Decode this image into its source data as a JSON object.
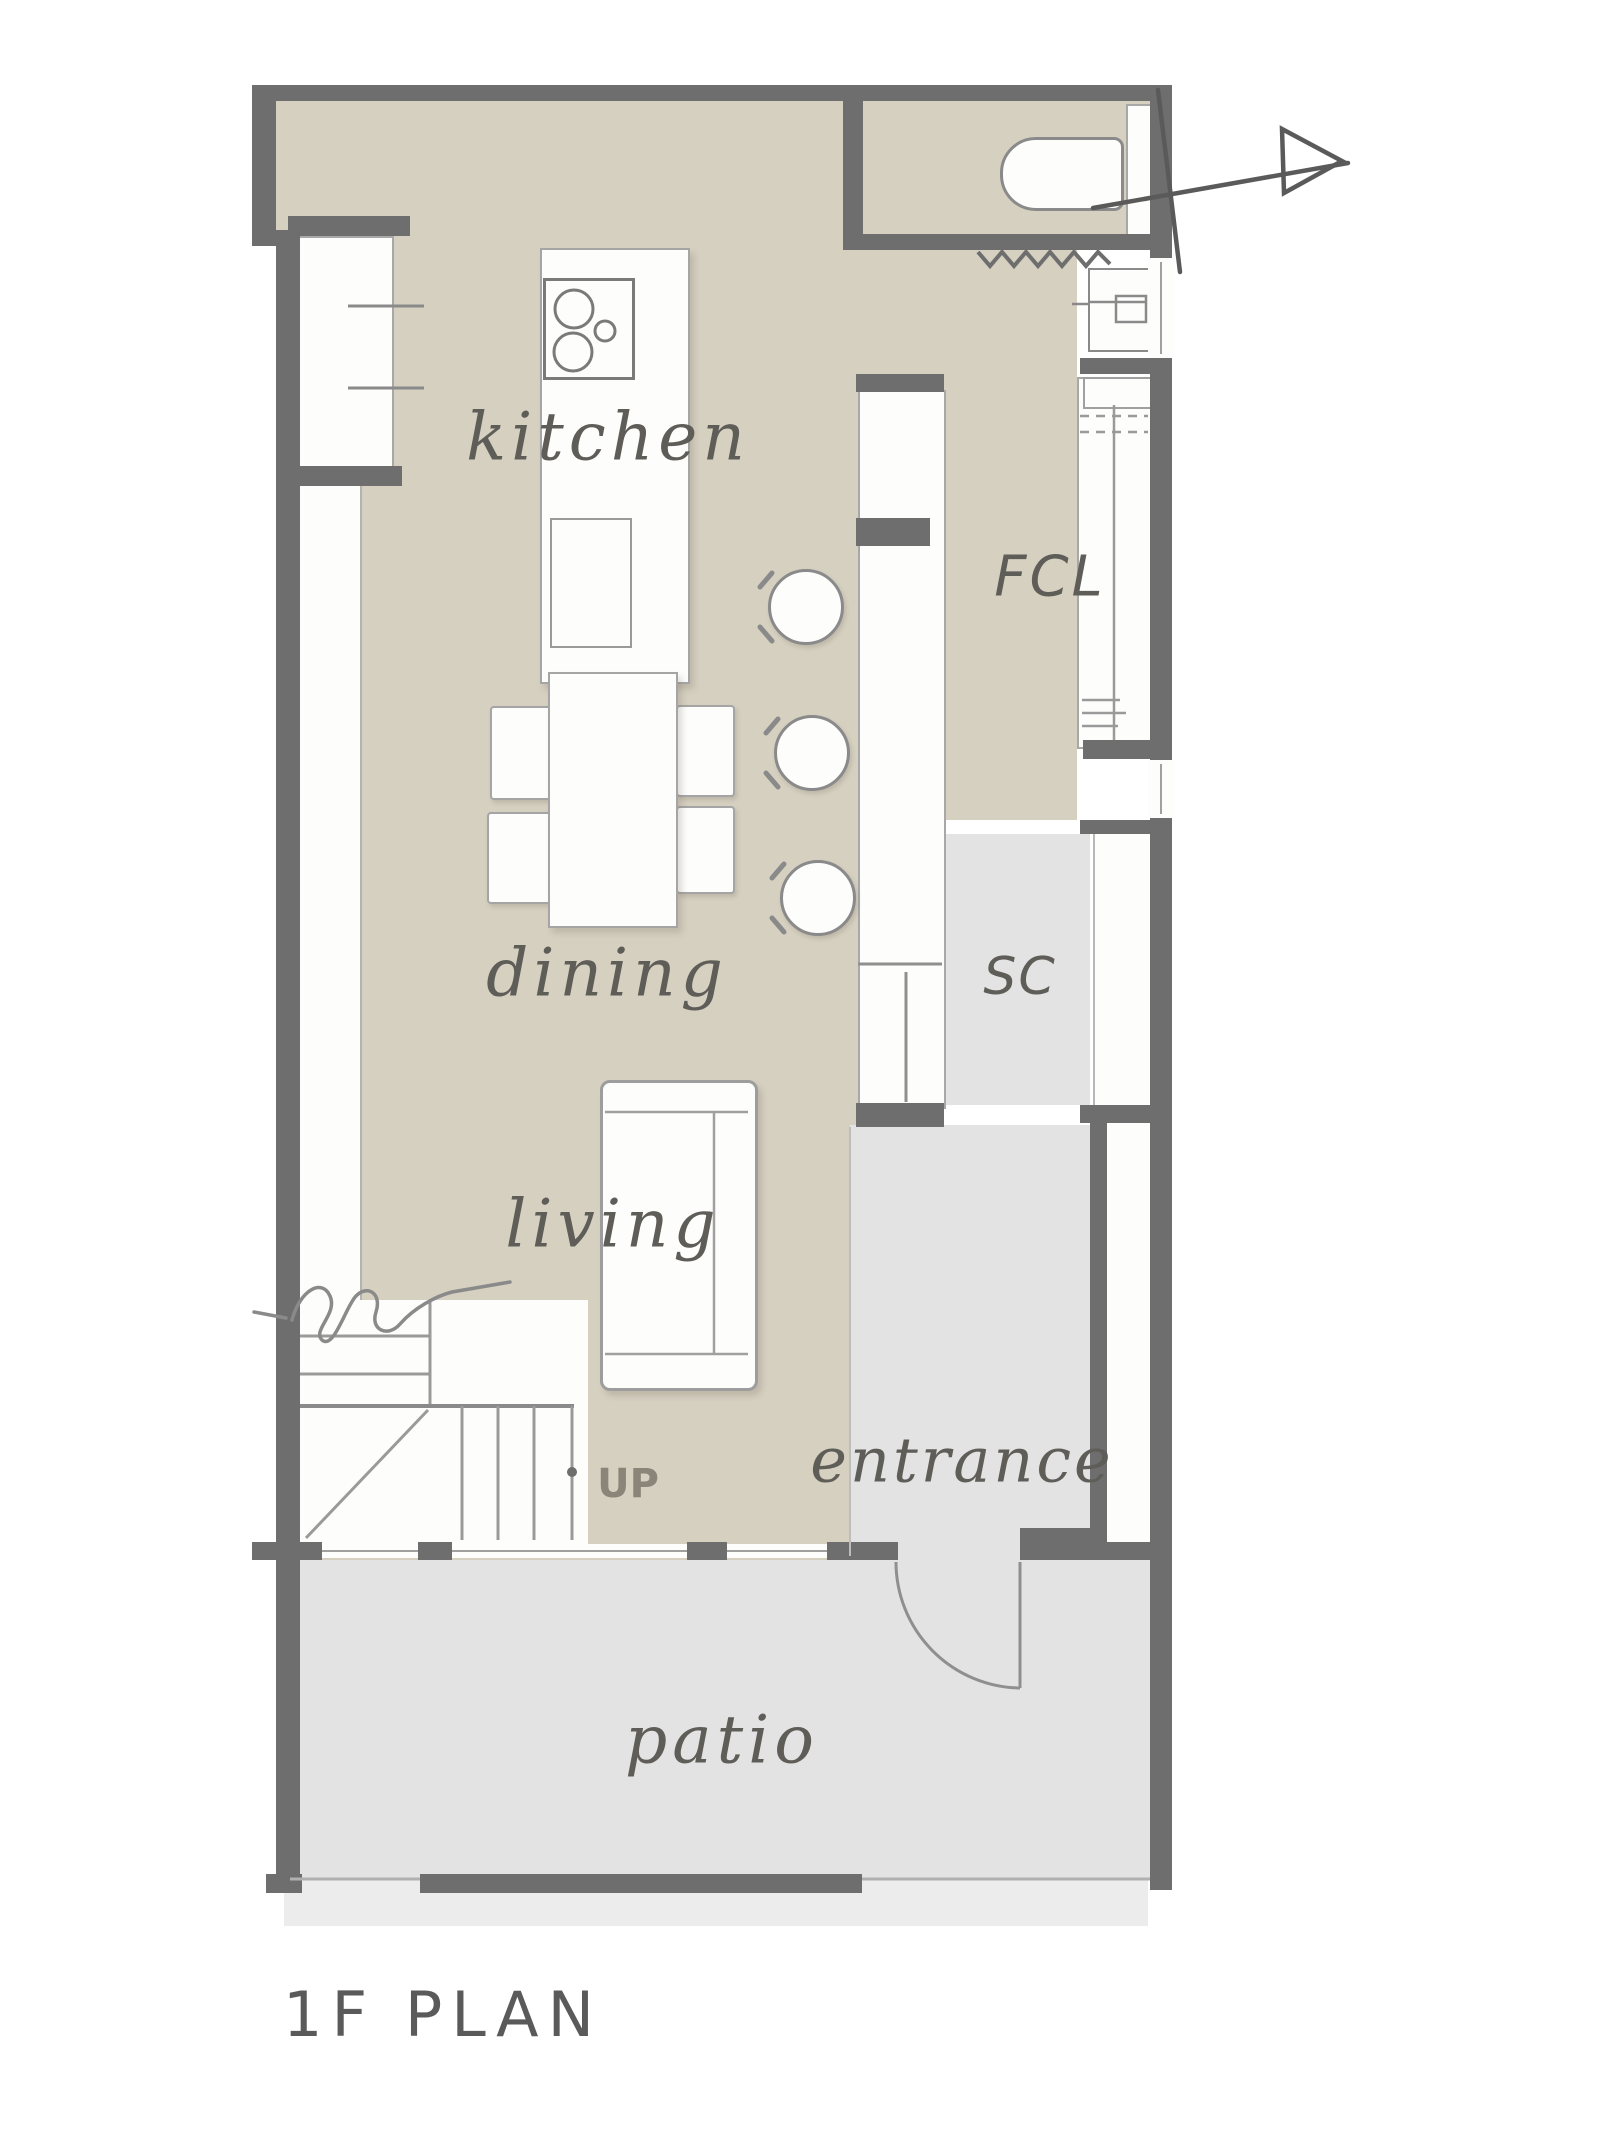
{
  "title": {
    "text": "1F PLAN"
  },
  "rooms": {
    "kitchen": "kitchen",
    "dining": "dining",
    "living": "living",
    "entrance": "entrance",
    "patio": "patio",
    "fcl": "FCL",
    "sc": "SC"
  },
  "annotations": {
    "up": "UP"
  },
  "icons": [
    "north-arrow-icon",
    "toilet-icon",
    "washbasin-icon",
    "stove-icon",
    "sink-icon",
    "stairs-icon",
    "door-swing-icon",
    "folding-door-icon",
    "break-line-icon"
  ],
  "colors": {
    "wood": "#d6d0c1",
    "hard": "#e3e3e4",
    "apron": "#ececed",
    "wall": "#6e6e6e",
    "line": "#9a9a9a",
    "soft": "#b5b5b5",
    "outline": "#8a8a8a",
    "label": "#5f5d58",
    "up": "#8b8478",
    "title": "#5a5a5a"
  }
}
